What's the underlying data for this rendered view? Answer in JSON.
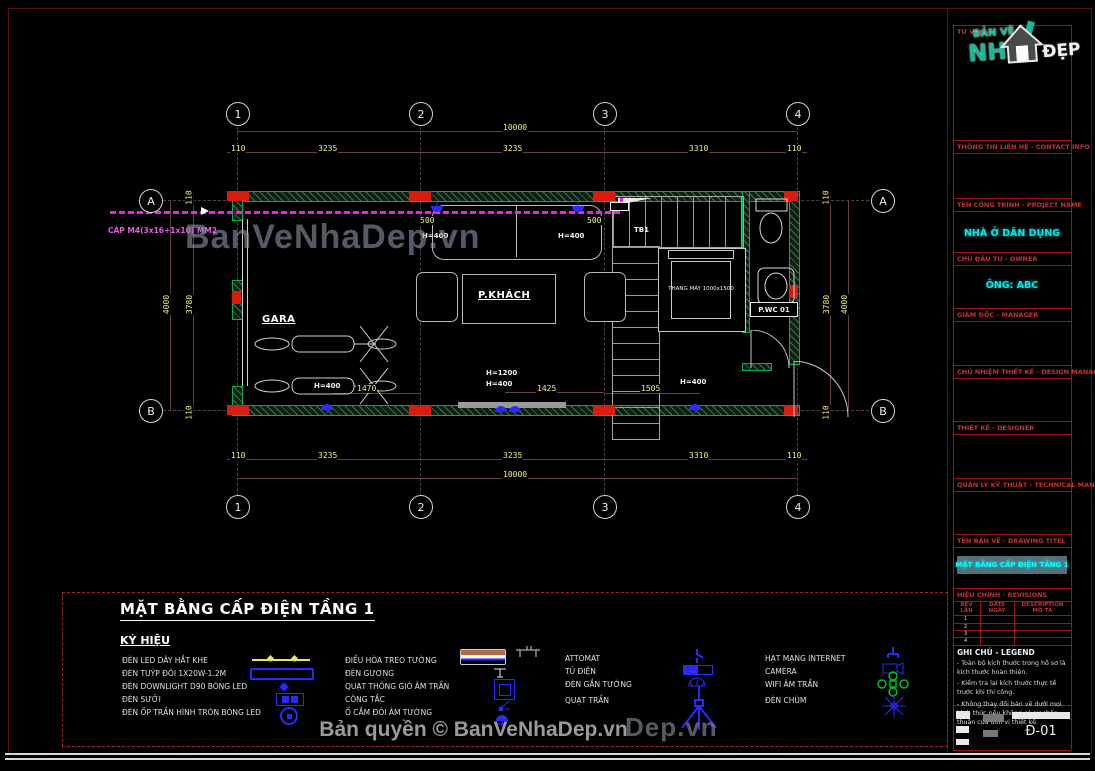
{
  "copyright": "Bản quyền © BanVeNhaDep.vn",
  "watermark": {
    "main": "BanVeNhaDep.vn",
    "partial": "Dep.vn"
  },
  "colors": {
    "wall_green": "#00b050",
    "column_red": "#d81c0e",
    "cable_magenta": "#e626e6",
    "dim_yellow": "#f0f07a",
    "value_cyan": "#00e8e8",
    "header_red": "#c23333",
    "symbol_blue": "#2a2aff",
    "wifi_green": "#00c020"
  },
  "sidebar": {
    "top_label": "TƯ VẤN -",
    "logo": {
      "banve": "BẢN VẼ",
      "nh": "NH",
      "dep": "ĐẸP",
      "house_icon": "house-logo-icon"
    },
    "sections": [
      {
        "label": "THÔNG TIN LIÊN HỆ - CONTACT INFO",
        "value": ""
      },
      {
        "label": "TÊN CÔNG TRÌNH - PROJECT NAME",
        "value": "NHÀ Ở DÂN DỤNG"
      },
      {
        "label": "CHỦ ĐẦU TƯ - OWNER",
        "value": "ÔNG: ABC"
      },
      {
        "label": "GIÁM ĐỐC - MANAGER",
        "value": ""
      },
      {
        "label": "CHỦ NHIỆM THIẾT KẾ - DESIGN MANAGER",
        "value": ""
      },
      {
        "label": "THIẾT KẾ - DESIGNER",
        "value": ""
      },
      {
        "label": "QUẢN LÝ KỸ THUẬT - TECHNICAL MANAGER",
        "value": ""
      },
      {
        "label": "TÊN BẢN VẼ - DRAWING TITEL",
        "value": "MẶT BẰNG CẤP ĐIỆN TẦNG 1"
      }
    ],
    "revisions": {
      "label": "HIỆU CHỈNH - REVISIONS",
      "columns": [
        {
          "en": "REV",
          "vi": "LẦN"
        },
        {
          "en": "DATE",
          "vi": "NGÀY"
        },
        {
          "en": "DESCRIPTION",
          "vi": "MÔ TẢ"
        }
      ],
      "rows": [
        "1",
        "2",
        "3",
        "4"
      ]
    },
    "notes": {
      "label": "GHI CHÚ - LEGEND",
      "items": [
        "- Toàn bộ kích thước trong hồ sơ là kích thước hoàn thiện.",
        "- Kiểm tra lại kích thước thực tế trước khi thi công.",
        "- Không thay đổi bản vẽ dưới mọi hình thức nếu không có sự chấp thuận của đơn vị thiết kế."
      ]
    },
    "drawing_number": "Đ-01"
  },
  "plan": {
    "grid": {
      "cols": [
        "1",
        "2",
        "3",
        "4"
      ],
      "rows": [
        "A",
        "B"
      ]
    },
    "dims": {
      "top_total": "10000",
      "top_segments": [
        "110",
        "3235",
        "3235",
        "3310",
        "110"
      ],
      "bottom_segments": [
        "110",
        "3235",
        "3235",
        "3310",
        "110"
      ],
      "bottom_total": "10000",
      "left_total": "4000",
      "left_segments": [
        "110",
        "3780",
        "110"
      ],
      "right_total": "4000",
      "right_segments": [
        "110",
        "3780",
        "110"
      ]
    },
    "rooms": {
      "gara": "GARA",
      "living": "P.KHÁCH",
      "wc": "P.WC 01",
      "elevator": "THANG MÁY 1000x1500"
    },
    "ann": {
      "tb1": "TB1",
      "cable": "CÁP M4(3x16+1x10) MM2",
      "h400": "H=400",
      "h1200": "H=1200",
      "d500": "500",
      "d1470": "1470",
      "d1425": "1425",
      "d1505": "1505"
    }
  },
  "legend": {
    "title": "MẶT BẰNG CẤP ĐIỆN TẦNG 1",
    "subtitle": "KÝ HIỆU",
    "columns": [
      {
        "items": [
          "ĐÈN LED DÂY HẮT KHE",
          "ĐÈN TUÝP ĐÔI 1X20W-1.2M",
          "ĐÈN DOWNLIGHT D90 BÓNG LED",
          "ĐÈN SƯỞI",
          "ĐÈN ỐP TRẦN HÌNH TRÒN BÓNG LED"
        ]
      },
      {
        "items": [
          "ĐIỀU HÒA TREO TƯỜNG",
          "ĐÈN GƯƠNG",
          "QUẠT THÔNG GIÓ ÂM TRẦN",
          "CÔNG TẮC",
          "Ổ CẮM ĐÔI ÂM TƯỜNG"
        ]
      },
      {
        "items": [
          "ATTOMAT",
          "TỦ ĐIỆN",
          "ĐÈN GẮN TƯỜNG",
          "QUẠT TRẦN"
        ]
      },
      {
        "items": [
          "HẠT MẠNG INTERNET",
          "CAMERA",
          "WIFI ÂM TRẦN",
          "ĐÈN CHÙM"
        ]
      }
    ]
  }
}
